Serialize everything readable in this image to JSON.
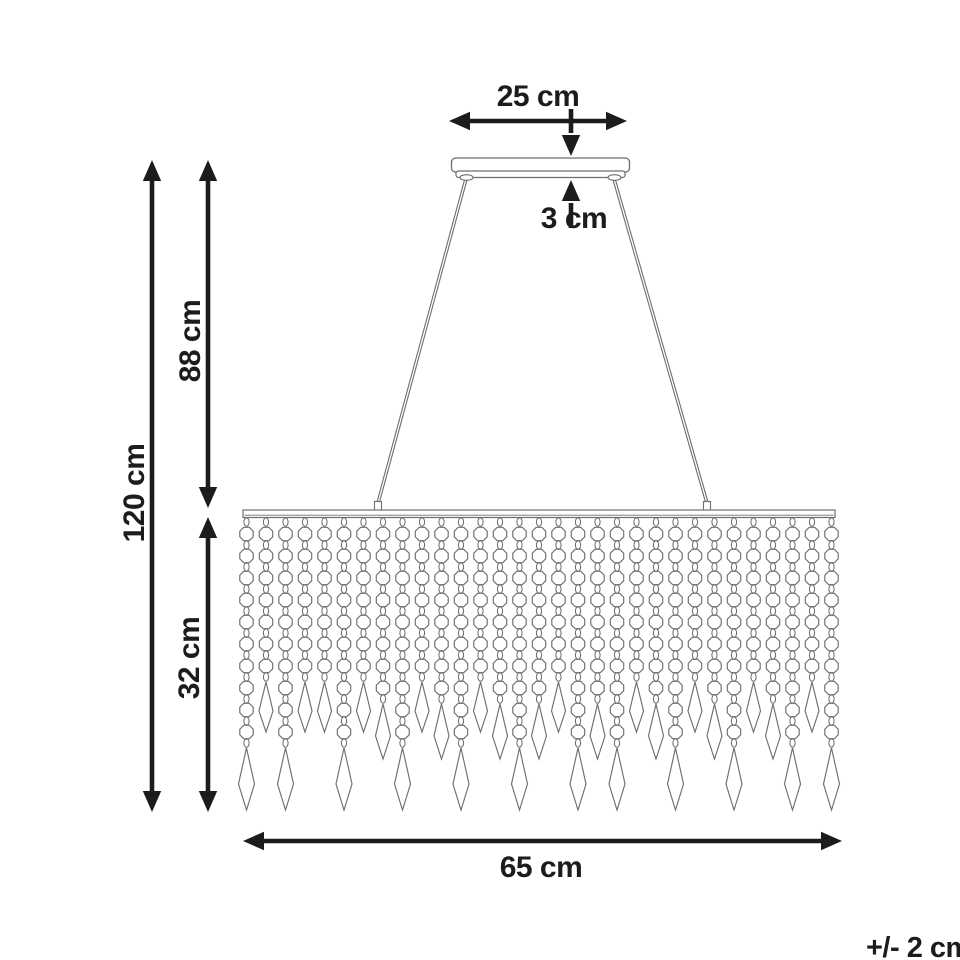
{
  "diagram": {
    "subject": "crystal-bead-pendant-chandelier-dimensions",
    "unit": "cm",
    "tolerance_note": "+/- 2 cm",
    "dimensions": {
      "canopy_width": {
        "label": "25 cm",
        "value": 25
      },
      "canopy_height": {
        "label": "3 cm",
        "value": 3
      },
      "suspension_height": {
        "label": "88 cm",
        "value": 88
      },
      "total_height": {
        "label": "120 cm",
        "value": 120
      },
      "curtain_height": {
        "label": "32 cm",
        "value": 32
      },
      "bar_width": {
        "label": "65 cm",
        "value": 65
      }
    },
    "colors": {
      "background": "#ffffff",
      "line_art": "#6e6e6e",
      "dimension_ink": "#1d1b1b"
    },
    "strands": {
      "count": 31,
      "bead_counts": [
        10,
        7,
        10,
        7,
        7,
        10,
        7,
        8,
        10,
        7,
        8,
        10,
        7,
        8,
        10,
        8,
        7,
        10,
        8,
        10,
        7,
        8,
        10,
        7,
        8,
        10,
        7,
        8,
        10,
        7,
        10
      ]
    }
  }
}
